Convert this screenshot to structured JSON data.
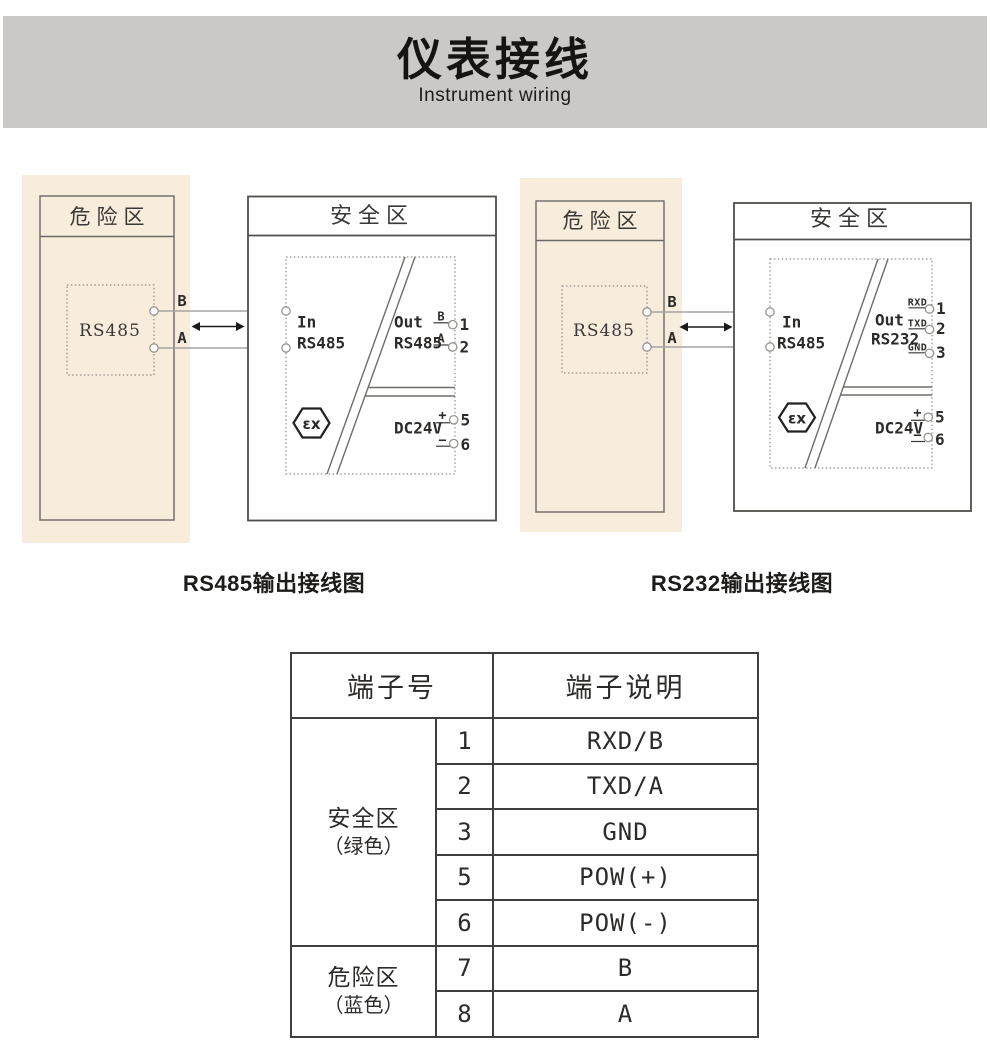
{
  "banner": {
    "title": "仪表接线",
    "subtitle": "Instrument wiring"
  },
  "diagrams": [
    {
      "caption": "RS485输出接线图",
      "danger_zone": {
        "title": "危险区",
        "device": "RS485",
        "wire_labels": {
          "top": "B",
          "bottom": "A"
        }
      },
      "safe_zone": {
        "title": "安全区",
        "module": {
          "in_label": "In",
          "in_type": "RS485",
          "in_terminal_top": "7",
          "in_terminal_bottom": "8",
          "out_label": "Out",
          "out_type": "RS485",
          "out_terminals": [
            {
              "signal": "B",
              "num": "1"
            },
            {
              "signal": "A",
              "num": "2"
            }
          ],
          "power_label": "DC24V",
          "power_terminals": [
            {
              "sign": "+",
              "num": "5"
            },
            {
              "sign": "−",
              "num": "6"
            }
          ],
          "ex_mark": "εx"
        }
      }
    },
    {
      "caption": "RS232输出接线图",
      "danger_zone": {
        "title": "危险区",
        "device": "RS485",
        "wire_labels": {
          "top": "B",
          "bottom": "A"
        }
      },
      "safe_zone": {
        "title": "安全区",
        "module": {
          "in_label": "In",
          "in_type": "RS485",
          "in_terminal_top": "7",
          "in_terminal_bottom": "8",
          "out_label": "Out",
          "out_type": "RS232",
          "out_terminals": [
            {
              "signal": "RXD",
              "num": "1"
            },
            {
              "signal": "TXD",
              "num": "2"
            },
            {
              "signal": "GND",
              "num": "3"
            }
          ],
          "power_label": "DC24V",
          "power_terminals": [
            {
              "sign": "+",
              "num": "5"
            },
            {
              "sign": "−",
              "num": "6"
            }
          ],
          "ex_mark": "εx"
        }
      }
    }
  ],
  "table": {
    "header": {
      "terminal_no": "端子号",
      "terminal_desc": "端子说明"
    },
    "groups": [
      {
        "zone": "安全区",
        "note": "（绿色）",
        "rows": [
          {
            "num": "1",
            "desc": "RXD/B"
          },
          {
            "num": "2",
            "desc": "TXD/A"
          },
          {
            "num": "3",
            "desc": "GND"
          },
          {
            "num": "5",
            "desc": "POW(+)"
          },
          {
            "num": "6",
            "desc": "POW(-)"
          }
        ]
      },
      {
        "zone": "危险区",
        "note": "（蓝色）",
        "rows": [
          {
            "num": "7",
            "desc": "B"
          },
          {
            "num": "8",
            "desc": "A"
          }
        ]
      }
    ]
  }
}
